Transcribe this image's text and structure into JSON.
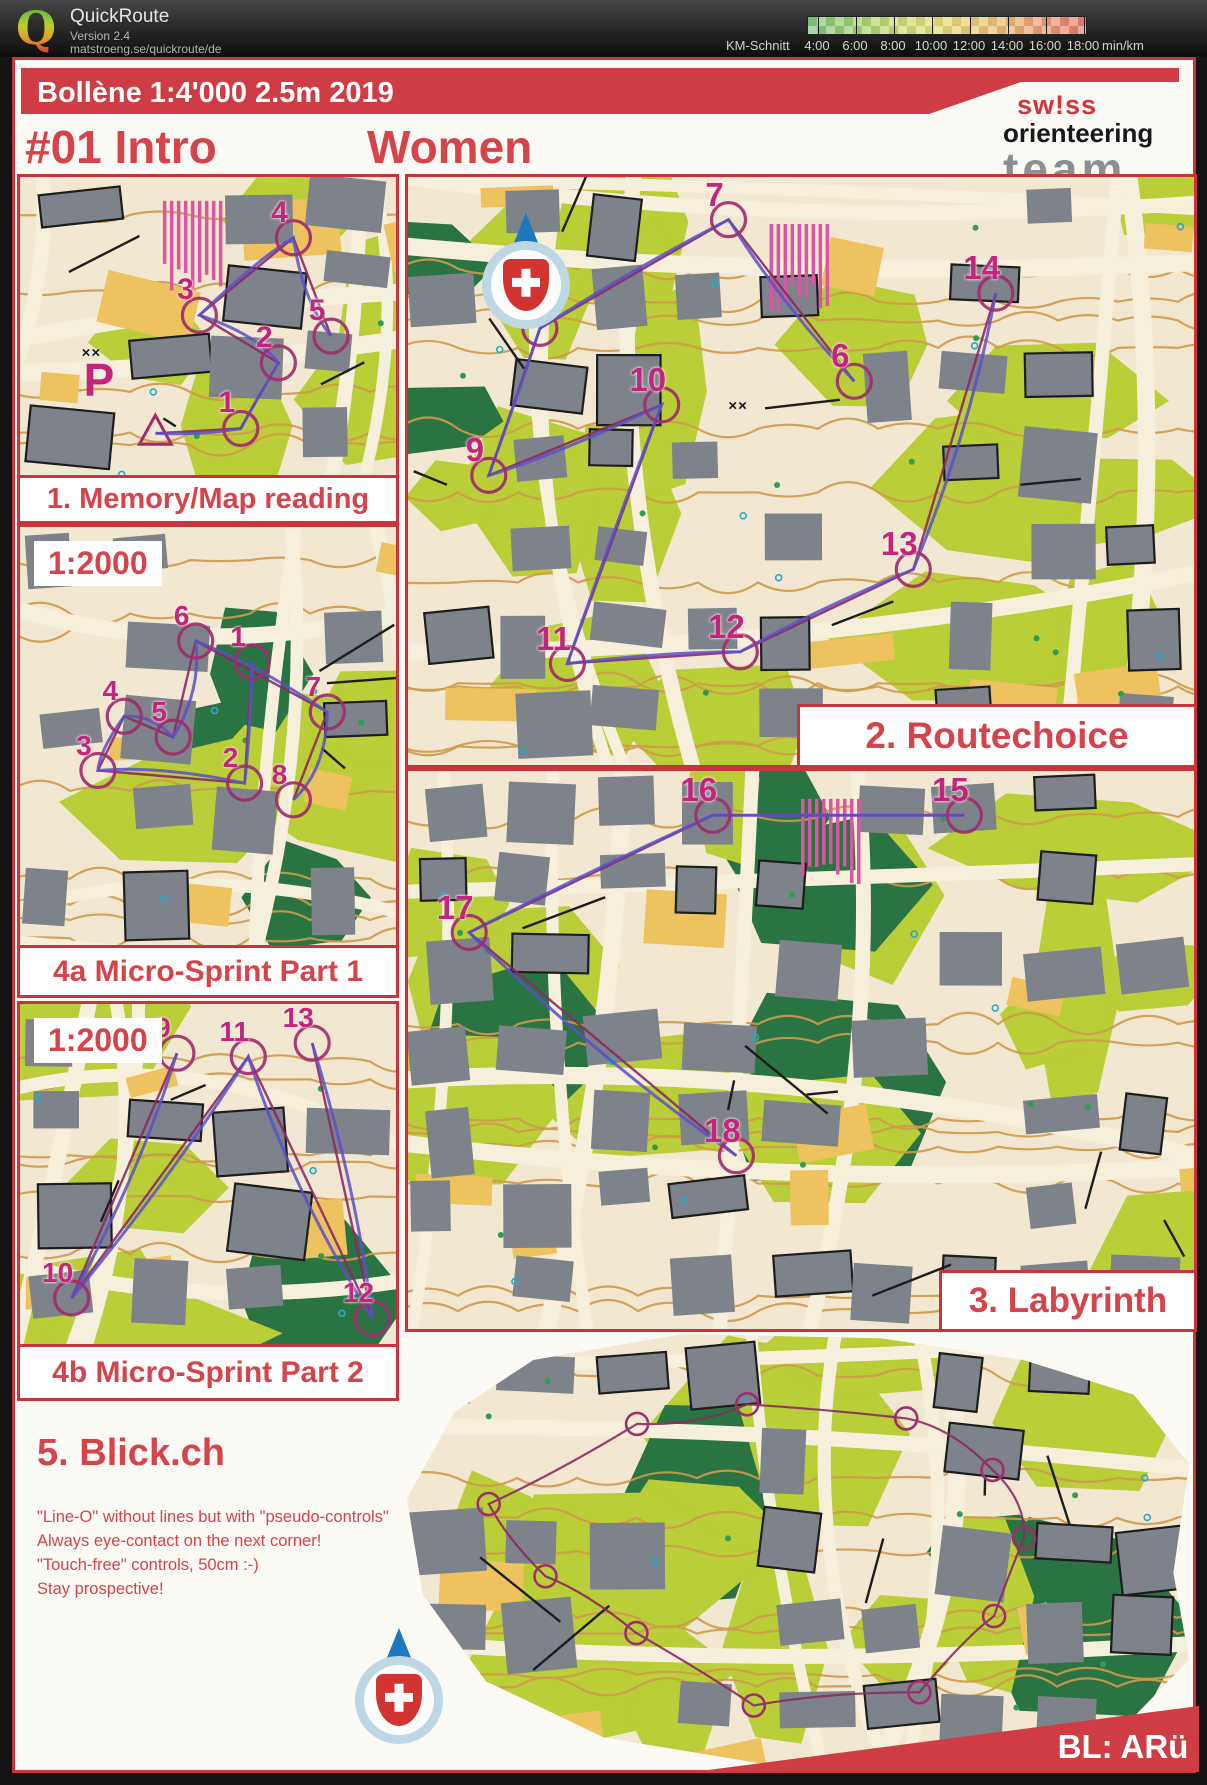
{
  "app": {
    "name": "QuickRoute",
    "version": "Version 2.4",
    "url": "matstroeng.se/quickroute/de",
    "scale": {
      "label": "KM-Schnitt",
      "ticks": [
        "4:00",
        "6:00",
        "8:00",
        "10:00",
        "12:00",
        "14:00",
        "16:00",
        "18:00"
      ],
      "unit": "min/km"
    }
  },
  "page": {
    "banner_title": "Bollène  1:4'000  2.5m  2019",
    "course": "#01 Intro",
    "category": "Women",
    "logo": {
      "line1": "sw!ss",
      "line2": "orienteering",
      "line3": "team"
    },
    "credit": "BL: ARü"
  },
  "sections": {
    "memory": {
      "label": "1. Memory/Map reading",
      "seed": 7,
      "numSize": 30,
      "controls": [
        {
          "n": "1",
          "x": 55,
          "y": 77
        },
        {
          "n": "2",
          "x": 65,
          "y": 55
        },
        {
          "n": "3",
          "x": 44,
          "y": 39
        },
        {
          "n": "4",
          "x": 69,
          "y": 13
        },
        {
          "n": "5",
          "x": 79,
          "y": 46
        }
      ],
      "start": {
        "x": 36,
        "y": 86
      },
      "marks": [
        {
          "t": "P",
          "x": 21,
          "y": 68,
          "cls": "p-mark"
        },
        {
          "t": "××",
          "x": 19,
          "y": 59,
          "cls": "x-mark"
        }
      ],
      "hatch": [
        38,
        8
      ]
    },
    "routechoice": {
      "label": "2. Routechoice",
      "seed": 3,
      "numSize": 33,
      "controls": [
        {
          "n": "6",
          "x": 55,
          "y": 31
        },
        {
          "n": "7",
          "x": 39,
          "y": 3.5
        },
        {
          "n": "8",
          "x": 15,
          "y": 22
        },
        {
          "n": "9",
          "x": 8.5,
          "y": 47
        },
        {
          "n": "10",
          "x": 30.5,
          "y": 35
        },
        {
          "n": "11",
          "x": 18.5,
          "y": 79
        },
        {
          "n": "12",
          "x": 40.5,
          "y": 77
        },
        {
          "n": "13",
          "x": 62.5,
          "y": 63
        },
        {
          "n": "14",
          "x": 73,
          "y": 16
        }
      ],
      "marks": [
        {
          "t": "××",
          "x": 42,
          "y": 39,
          "cls": "x-mark"
        }
      ],
      "hatch": [
        46,
        8
      ]
    },
    "sprint1": {
      "label": "4a Micro-Sprint Part 1",
      "scale_note": "1:2000",
      "seed": 11,
      "numSize": 28,
      "controls": [
        {
          "n": "1",
          "x": 58,
          "y": 27
        },
        {
          "n": "2",
          "x": 56,
          "y": 56
        },
        {
          "n": "3",
          "x": 17,
          "y": 53
        },
        {
          "n": "4",
          "x": 24,
          "y": 40
        },
        {
          "n": "5",
          "x": 37,
          "y": 45
        },
        {
          "n": "6",
          "x": 43,
          "y": 22
        },
        {
          "n": "7",
          "x": 78,
          "y": 39
        },
        {
          "n": "8",
          "x": 69,
          "y": 60
        }
      ]
    },
    "sprint2": {
      "label": "4b Micro-Sprint Part 2",
      "scale_note": "1:2000",
      "seed": 23,
      "numSize": 28,
      "controls": [
        {
          "n": "9",
          "x": 38,
          "y": 8
        },
        {
          "n": "10",
          "x": 10,
          "y": 80
        },
        {
          "n": "11",
          "x": 57,
          "y": 9
        },
        {
          "n": "12",
          "x": 90,
          "y": 86
        },
        {
          "n": "13",
          "x": 74,
          "y": 5
        }
      ]
    },
    "labyrinth": {
      "label": "3. Labyrinth",
      "seed": 15,
      "numSize": 33,
      "controls": [
        {
          "n": "15",
          "x": 69,
          "y": 4
        },
        {
          "n": "16",
          "x": 37,
          "y": 4
        },
        {
          "n": "17",
          "x": 6,
          "y": 25
        },
        {
          "n": "18",
          "x": 40,
          "y": 65
        }
      ],
      "hatch": [
        50,
        5
      ]
    },
    "blick": {
      "heading": "5. Blick.ch",
      "seed": 29,
      "lines": [
        "\"Line-O\" without lines but with \"pseudo-controls\"",
        "Always eye-contact on the next corner!",
        "\"Touch-free\" controls, 50cm :-)",
        "Stay prospective!"
      ]
    }
  }
}
